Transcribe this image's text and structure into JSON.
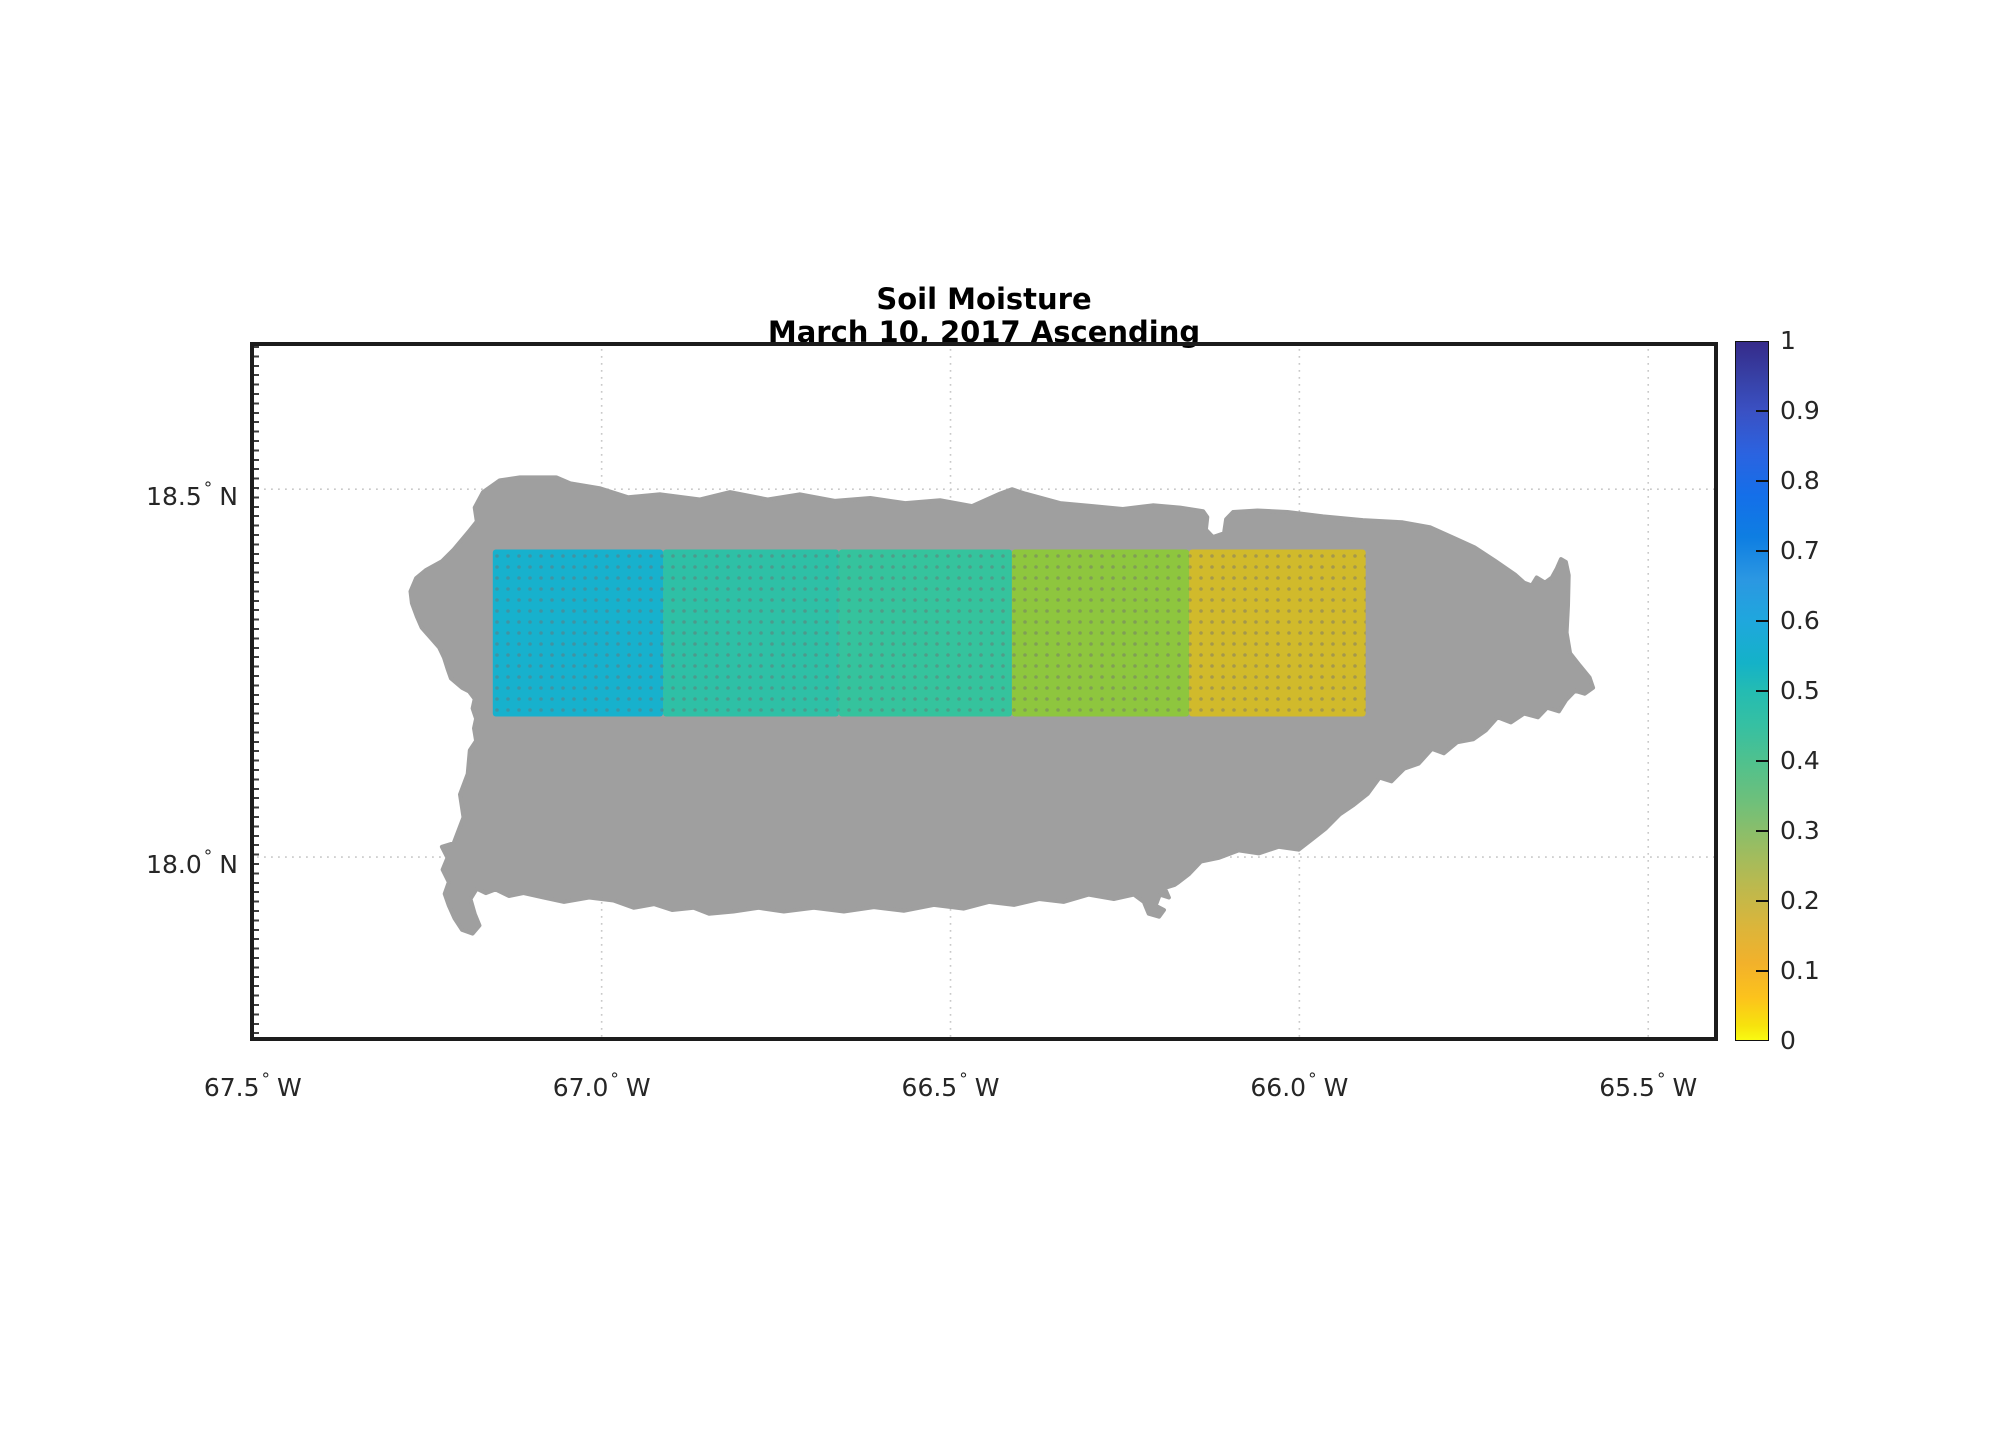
{
  "title": {
    "line1": "Soil Moisture",
    "line2": "March 10, 2017 Ascending"
  },
  "axes": {
    "degree_symbol": "°",
    "x": {
      "ticks": [
        {
          "label": "67.5",
          "hemisphere": "W",
          "lon": -67.5
        },
        {
          "label": "67.0",
          "hemisphere": "W",
          "lon": -67.0
        },
        {
          "label": "66.5",
          "hemisphere": "W",
          "lon": -66.5
        },
        {
          "label": "66.0",
          "hemisphere": "W",
          "lon": -66.0
        },
        {
          "label": "65.5",
          "hemisphere": "W",
          "lon": -65.5
        }
      ]
    },
    "y": {
      "ticks": [
        {
          "label": "18.5",
          "hemisphere": "N",
          "lat": 18.5
        },
        {
          "label": "18.0",
          "hemisphere": "N",
          "lat": 18.0
        }
      ]
    }
  },
  "colorbar": {
    "min": 0,
    "max": 1,
    "ticks": [
      {
        "label": "1",
        "value": 1.0
      },
      {
        "label": "0.9",
        "value": 0.9
      },
      {
        "label": "0.8",
        "value": 0.8
      },
      {
        "label": "0.7",
        "value": 0.7
      },
      {
        "label": "0.6",
        "value": 0.6
      },
      {
        "label": "0.5",
        "value": 0.5
      },
      {
        "label": "0.4",
        "value": 0.4
      },
      {
        "label": "0.3",
        "value": 0.3
      },
      {
        "label": "0.2",
        "value": 0.2
      },
      {
        "label": "0.1",
        "value": 0.1
      },
      {
        "label": "0",
        "value": 0.0
      }
    ],
    "gradient_stops": [
      {
        "pos": 0.0,
        "color": "#362b8a"
      },
      {
        "pos": 0.05,
        "color": "#3740a5"
      },
      {
        "pos": 0.1,
        "color": "#3a51c4"
      },
      {
        "pos": 0.16,
        "color": "#2b63e0"
      },
      {
        "pos": 0.22,
        "color": "#146fe9"
      },
      {
        "pos": 0.28,
        "color": "#0e7ee2"
      },
      {
        "pos": 0.34,
        "color": "#2b97e2"
      },
      {
        "pos": 0.4,
        "color": "#1fa7dd"
      },
      {
        "pos": 0.46,
        "color": "#14b2c8"
      },
      {
        "pos": 0.5,
        "color": "#24bcb2"
      },
      {
        "pos": 0.55,
        "color": "#36c0a2"
      },
      {
        "pos": 0.6,
        "color": "#4fc18e"
      },
      {
        "pos": 0.66,
        "color": "#6fc07a"
      },
      {
        "pos": 0.72,
        "color": "#97bd63"
      },
      {
        "pos": 0.78,
        "color": "#bcb94e"
      },
      {
        "pos": 0.84,
        "color": "#dcb53a"
      },
      {
        "pos": 0.89,
        "color": "#f2b12b"
      },
      {
        "pos": 0.94,
        "color": "#fcc31c"
      },
      {
        "pos": 0.98,
        "color": "#f7e30d"
      },
      {
        "pos": 1.0,
        "color": "#f9fa12"
      }
    ]
  },
  "colors": {
    "island_fill": "#9f9f9f",
    "gridline": "#c9c9c9",
    "frame": "#1c1c1c",
    "background": "#ffffff",
    "cell_dot_overlay": "rgba(110,110,110,0.45)"
  },
  "chart_data": {
    "type": "heatmap",
    "title": "Soil Moisture",
    "subtitle": "March 10, 2017 Ascending",
    "region": "Puerto Rico",
    "value_label": "soil moisture (0-1)",
    "xlim_lon": [
      -67.504,
      -65.4
    ],
    "ylim_lat": [
      17.75,
      18.7
    ],
    "xticks_lon": [
      -67.5,
      -67.0,
      -66.5,
      -66.0,
      -65.5
    ],
    "yticks_lat": [
      18.5,
      18.0
    ],
    "grid": true,
    "colorbar_range": [
      0,
      1
    ],
    "cells": [
      {
        "lon_min": -67.156,
        "lon_max": -66.912,
        "lat_min": 18.191,
        "lat_max": 18.418,
        "value": 0.56,
        "color": "#17b1cd"
      },
      {
        "lon_min": -66.912,
        "lon_max": -66.66,
        "lat_min": 18.191,
        "lat_max": 18.418,
        "value": 0.47,
        "color": "#2ec0a6"
      },
      {
        "lon_min": -66.66,
        "lon_max": -66.412,
        "lat_min": 18.191,
        "lat_max": 18.418,
        "value": 0.45,
        "color": "#35c39d"
      },
      {
        "lon_min": -66.412,
        "lon_max": -66.158,
        "lat_min": 18.191,
        "lat_max": 18.418,
        "value": 0.32,
        "color": "#8ec63e"
      },
      {
        "lon_min": -66.158,
        "lon_max": -65.905,
        "lat_min": 18.191,
        "lat_max": 18.418,
        "value": 0.2,
        "color": "#d1ba2b"
      }
    ],
    "island": {
      "name": "Puerto Rico",
      "outline_lonlat": [
        [
          -67.17,
          18.496
        ],
        [
          -67.146,
          18.512
        ],
        [
          -67.117,
          18.516
        ],
        [
          -67.065,
          18.516
        ],
        [
          -67.045,
          18.508
        ],
        [
          -67.002,
          18.501
        ],
        [
          -66.962,
          18.489
        ],
        [
          -66.916,
          18.493
        ],
        [
          -66.859,
          18.486
        ],
        [
          -66.816,
          18.496
        ],
        [
          -66.762,
          18.486
        ],
        [
          -66.716,
          18.493
        ],
        [
          -66.666,
          18.484
        ],
        [
          -66.615,
          18.488
        ],
        [
          -66.565,
          18.481
        ],
        [
          -66.515,
          18.485
        ],
        [
          -66.469,
          18.477
        ],
        [
          -66.429,
          18.494
        ],
        [
          -66.412,
          18.5
        ],
        [
          -66.393,
          18.494
        ],
        [
          -66.343,
          18.481
        ],
        [
          -66.296,
          18.477
        ],
        [
          -66.253,
          18.473
        ],
        [
          -66.21,
          18.478
        ],
        [
          -66.171,
          18.475
        ],
        [
          -66.138,
          18.47
        ],
        [
          -66.132,
          18.462
        ],
        [
          -66.134,
          18.445
        ],
        [
          -66.124,
          18.435
        ],
        [
          -66.108,
          18.44
        ],
        [
          -66.105,
          18.459
        ],
        [
          -66.095,
          18.469
        ],
        [
          -66.06,
          18.471
        ],
        [
          -66.017,
          18.469
        ],
        [
          -65.966,
          18.463
        ],
        [
          -65.909,
          18.458
        ],
        [
          -65.852,
          18.455
        ],
        [
          -65.812,
          18.448
        ],
        [
          -65.777,
          18.433
        ],
        [
          -65.749,
          18.421
        ],
        [
          -65.72,
          18.403
        ],
        [
          -65.691,
          18.384
        ],
        [
          -65.678,
          18.373
        ],
        [
          -65.667,
          18.369
        ],
        [
          -65.66,
          18.38
        ],
        [
          -65.648,
          18.373
        ],
        [
          -65.638,
          18.38
        ],
        [
          -65.631,
          18.392
        ],
        [
          -65.625,
          18.405
        ],
        [
          -65.618,
          18.401
        ],
        [
          -65.614,
          18.383
        ],
        [
          -65.615,
          18.342
        ],
        [
          -65.617,
          18.305
        ],
        [
          -65.612,
          18.277
        ],
        [
          -65.598,
          18.26
        ],
        [
          -65.584,
          18.244
        ],
        [
          -65.579,
          18.23
        ],
        [
          -65.591,
          18.222
        ],
        [
          -65.605,
          18.226
        ],
        [
          -65.618,
          18.213
        ],
        [
          -65.628,
          18.198
        ],
        [
          -65.645,
          18.203
        ],
        [
          -65.658,
          18.19
        ],
        [
          -65.678,
          18.195
        ],
        [
          -65.697,
          18.183
        ],
        [
          -65.716,
          18.19
        ],
        [
          -65.733,
          18.172
        ],
        [
          -65.751,
          18.16
        ],
        [
          -65.774,
          18.156
        ],
        [
          -65.793,
          18.141
        ],
        [
          -65.81,
          18.147
        ],
        [
          -65.829,
          18.127
        ],
        [
          -65.85,
          18.12
        ],
        [
          -65.868,
          18.103
        ],
        [
          -65.885,
          18.108
        ],
        [
          -65.902,
          18.086
        ],
        [
          -65.922,
          18.071
        ],
        [
          -65.942,
          18.058
        ],
        [
          -65.962,
          18.039
        ],
        [
          -65.982,
          18.024
        ],
        [
          -66.001,
          18.01
        ],
        [
          -66.03,
          18.014
        ],
        [
          -66.058,
          18.005
        ],
        [
          -66.087,
          18.009
        ],
        [
          -66.115,
          17.999
        ],
        [
          -66.141,
          17.994
        ],
        [
          -66.158,
          17.977
        ],
        [
          -66.173,
          17.966
        ],
        [
          -66.179,
          17.962
        ],
        [
          -66.193,
          17.958
        ],
        [
          -66.187,
          17.945
        ],
        [
          -66.2,
          17.949
        ],
        [
          -66.206,
          17.934
        ],
        [
          -66.194,
          17.928
        ],
        [
          -66.201,
          17.919
        ],
        [
          -66.216,
          17.923
        ],
        [
          -66.223,
          17.939
        ],
        [
          -66.237,
          17.949
        ],
        [
          -66.266,
          17.943
        ],
        [
          -66.302,
          17.949
        ],
        [
          -66.338,
          17.939
        ],
        [
          -66.373,
          17.943
        ],
        [
          -66.409,
          17.935
        ],
        [
          -66.445,
          17.939
        ],
        [
          -66.481,
          17.93
        ],
        [
          -66.524,
          17.935
        ],
        [
          -66.567,
          17.927
        ],
        [
          -66.61,
          17.932
        ],
        [
          -66.653,
          17.926
        ],
        [
          -66.696,
          17.931
        ],
        [
          -66.739,
          17.926
        ],
        [
          -66.775,
          17.931
        ],
        [
          -66.811,
          17.926
        ],
        [
          -66.846,
          17.923
        ],
        [
          -66.868,
          17.931
        ],
        [
          -66.899,
          17.928
        ],
        [
          -66.925,
          17.936
        ],
        [
          -66.954,
          17.931
        ],
        [
          -66.983,
          17.941
        ],
        [
          -67.018,
          17.945
        ],
        [
          -67.054,
          17.939
        ],
        [
          -67.083,
          17.945
        ],
        [
          -67.112,
          17.951
        ],
        [
          -67.133,
          17.947
        ],
        [
          -67.152,
          17.956
        ],
        [
          -67.166,
          17.951
        ],
        [
          -67.179,
          17.957
        ],
        [
          -67.188,
          17.943
        ],
        [
          -67.182,
          17.923
        ],
        [
          -67.175,
          17.907
        ],
        [
          -67.185,
          17.896
        ],
        [
          -67.2,
          17.901
        ],
        [
          -67.211,
          17.917
        ],
        [
          -67.219,
          17.934
        ],
        [
          -67.225,
          17.95
        ],
        [
          -67.219,
          17.966
        ],
        [
          -67.228,
          17.983
        ],
        [
          -67.221,
          17.999
        ],
        [
          -67.229,
          18.014
        ],
        [
          -67.212,
          18.019
        ],
        [
          -67.198,
          18.054
        ],
        [
          -67.203,
          18.085
        ],
        [
          -67.192,
          18.113
        ],
        [
          -67.189,
          18.145
        ],
        [
          -67.18,
          18.158
        ],
        [
          -67.183,
          18.175
        ],
        [
          -67.18,
          18.188
        ],
        [
          -67.185,
          18.202
        ],
        [
          -67.182,
          18.215
        ],
        [
          -67.19,
          18.225
        ],
        [
          -67.2,
          18.23
        ],
        [
          -67.216,
          18.243
        ],
        [
          -67.221,
          18.256
        ],
        [
          -67.226,
          18.271
        ],
        [
          -67.233,
          18.285
        ],
        [
          -67.246,
          18.299
        ],
        [
          -67.258,
          18.312
        ],
        [
          -67.265,
          18.327
        ],
        [
          -67.272,
          18.345
        ],
        [
          -67.274,
          18.361
        ],
        [
          -67.266,
          18.379
        ],
        [
          -67.252,
          18.39
        ],
        [
          -67.229,
          18.402
        ],
        [
          -67.212,
          18.418
        ],
        [
          -67.19,
          18.443
        ],
        [
          -67.179,
          18.456
        ],
        [
          -67.182,
          18.475
        ]
      ]
    }
  }
}
